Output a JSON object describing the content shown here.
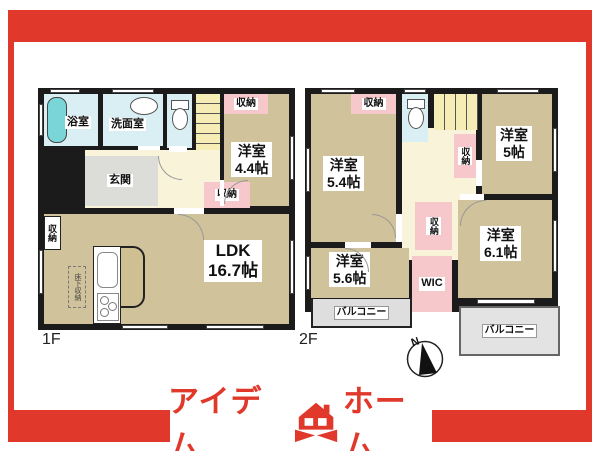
{
  "floor1": {
    "label": "1F",
    "bath": "浴室",
    "washroom": "洗面室",
    "entrance": "玄関",
    "ldk_name": "LDK",
    "ldk_size": "16.7帖",
    "bedroom_name": "洋室",
    "bedroom_size": "4.4帖",
    "underfloor_storage": "床下収納"
  },
  "floor2": {
    "label": "2F",
    "bedroom1_name": "洋室",
    "bedroom1_size": "5.4帖",
    "bedroom2_name": "洋室",
    "bedroom2_size": "5帖",
    "bedroom3_name": "洋室",
    "bedroom3_size": "5.6帖",
    "bedroom4_name": "洋室",
    "bedroom4_size": "6.1帖",
    "wic": "WIC"
  },
  "labels": {
    "storage": "収納",
    "balcony": "バルコニー"
  },
  "compass": {
    "north": "N"
  },
  "brand": {
    "name_left": "アイデム",
    "name_right": "ホーム"
  },
  "colors": {
    "accent_red": "#e0382a",
    "wall_black": "#1b1b1b",
    "room_tan": "#d0c29a",
    "hall_yellow": "#f8f3d9",
    "stairs_yellow": "#f5edb5",
    "water_blue": "#d9eff3",
    "bathtub_teal": "#79d5d8",
    "storage_pink": "#f6c8cc",
    "balcony_gray": "#dedede",
    "entrance_gray": "#dcdcd9"
  }
}
